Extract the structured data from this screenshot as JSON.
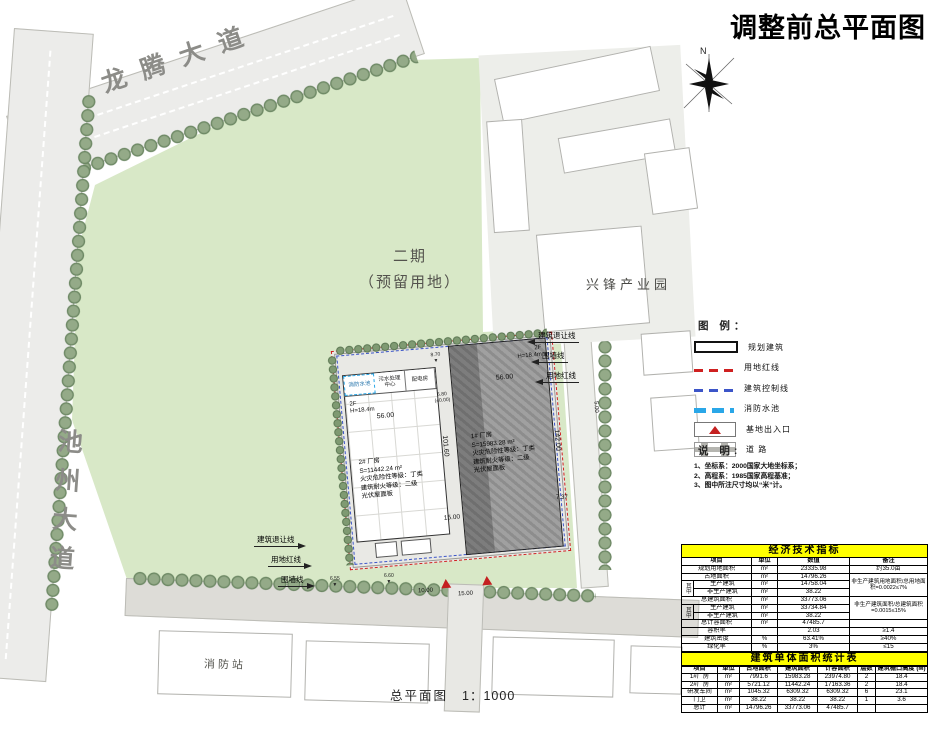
{
  "title": "调整前总平面图",
  "plan": {
    "roads": {
      "longteng": "龙腾大道",
      "chizhou": "池州大道"
    },
    "areas": {
      "phase2_line1": "二期",
      "phase2_line2": "（预留用地）",
      "industrial_park": "兴锋产业园",
      "fire_station": "消防站"
    },
    "caption": {
      "name": "总平面图",
      "scale": "1：1000"
    },
    "north_label": "N",
    "buildings": {
      "b1": {
        "name": "1# 厂房",
        "area": "S=15983.28 m²",
        "fire_risk": "火灾危险性等级：丁类",
        "fire_rating": "建筑耐火等级：二级",
        "roof": "光伏屋面板",
        "floors": "2F",
        "height": "H=18.4m",
        "width": "56.00",
        "length": "142.00"
      },
      "b2": {
        "name": "2# 厂房",
        "area": "S=11442.24 m²",
        "fire_risk": "火灾危险性等级：丁类",
        "fire_rating": "建筑耐火等级：二级",
        "roof": "光伏屋面板",
        "floors": "2F",
        "height": "H=18.4m",
        "width": "56.00",
        "length": "101.60"
      },
      "rooms": [
        "消防水池",
        "污水处理中心",
        "配电房"
      ]
    },
    "dims": {
      "gap": "15.00",
      "d10": "10.00",
      "d15": "15.00",
      "d5": "5.00",
      "d737": "7.37"
    },
    "levels": {
      "l680": "6.80",
      "l000": "(±0.00)",
      "l870": "8.70",
      "l655": "6.55",
      "l660": "6.60"
    },
    "leaders_right": [
      "建筑退让线",
      "围墙线",
      "用地红线"
    ],
    "leaders_left": [
      "建筑退让线",
      "用地红线",
      "围墙线"
    ]
  },
  "legend": {
    "title": "图 例：",
    "items": [
      {
        "label": "规划建筑",
        "symbol": "planned-building"
      },
      {
        "label": "用地红线",
        "symbol": "red-boundary-line"
      },
      {
        "label": "建筑控制线",
        "symbol": "building-control-line"
      },
      {
        "label": "消防水池",
        "symbol": "fire-pool-line"
      },
      {
        "label": "基地出入口",
        "symbol": "site-entrance"
      },
      {
        "label": "道  路",
        "symbol": "road"
      }
    ]
  },
  "notes": {
    "title": "说 明:",
    "lines": [
      "1、坐标系：2000国家大地坐标系；",
      "2、高程系：1985国家高程基准；",
      "3、图中所注尺寸均以“米”计。"
    ]
  },
  "tables": {
    "econ": {
      "title": "经济技术指标",
      "widths": [
        12,
        58,
        26,
        72,
        78
      ],
      "header": [
        {
          "t": "项目",
          "cs": 2
        },
        "单位",
        "数值",
        "备注"
      ],
      "rows": [
        [
          {
            "t": "规划用地面积",
            "cs": 2
          },
          "m²",
          "23335.98",
          "约35.0亩"
        ],
        [
          {
            "t": "占地面积",
            "cs": 2
          },
          "m²",
          "14796.26",
          {
            "t": "非生产建筑用地面积/总用地面积=0.0022≤7%",
            "rs": 3,
            "cls": "small"
          }
        ],
        [
          {
            "t": "其中",
            "rs": 2,
            "cls": "vert"
          },
          "生产建筑",
          "m²",
          "14758.04"
        ],
        [
          "非生产建筑",
          "m²",
          "38.22"
        ],
        [
          {
            "t": "总建筑面积",
            "cs": 2
          },
          "m²",
          "33773.06",
          {
            "t": "非生产建筑面积/总建筑面积=0.0015≤15%",
            "rs": 3,
            "cls": "small"
          }
        ],
        [
          {
            "t": "其中",
            "rs": 2,
            "cls": "vert"
          },
          "生产建筑",
          "m²",
          "33734.84"
        ],
        [
          "非生产建筑",
          "m²",
          "38.22"
        ],
        [
          {
            "t": "总计容面积",
            "cs": 2
          },
          "m²",
          "47485.7",
          ""
        ],
        [
          {
            "t": "容积率",
            "cs": 2
          },
          "",
          "2.03",
          "≥1.4"
        ],
        [
          {
            "t": "建筑密度",
            "cs": 2
          },
          "%",
          "63.41%",
          "≥40%"
        ],
        [
          {
            "t": "绿化率",
            "cs": 2
          },
          "%",
          "3%",
          "≤15"
        ],
        [
          {
            "t": "机动车位",
            "cs": 2
          },
          "辆",
          "102",
          ""
        ],
        [
          {
            "t": "非机动车位",
            "cs": 2
          },
          "辆",
          "50",
          ""
        ]
      ]
    },
    "units": {
      "title": "建筑单体面积统计表",
      "widths": [
        36,
        22,
        38,
        40,
        40,
        18,
        52
      ],
      "header": [
        "项目",
        "单位",
        "占地面积",
        "建筑面积",
        "计容面积",
        "层数",
        "建筑檐口高度 (M)"
      ],
      "rows": [
        [
          "1#厂房",
          "m²",
          "7991.6",
          "15983.28",
          "23974.80",
          "2",
          "18.4"
        ],
        [
          "2#厂房",
          "m²",
          "5721.12",
          "11442.24",
          "17163.36",
          "2",
          "18.4"
        ],
        [
          "研发车间",
          "m²",
          "1045.32",
          "6309.32",
          "6309.32",
          "6",
          "23.1"
        ],
        [
          "门卫",
          "m²",
          "38.22",
          "38.22",
          "38.22",
          "1",
          "3.6"
        ],
        [
          "总计",
          "m²",
          "14796.26",
          "33773.06",
          "47485.7",
          "",
          ""
        ]
      ]
    }
  }
}
